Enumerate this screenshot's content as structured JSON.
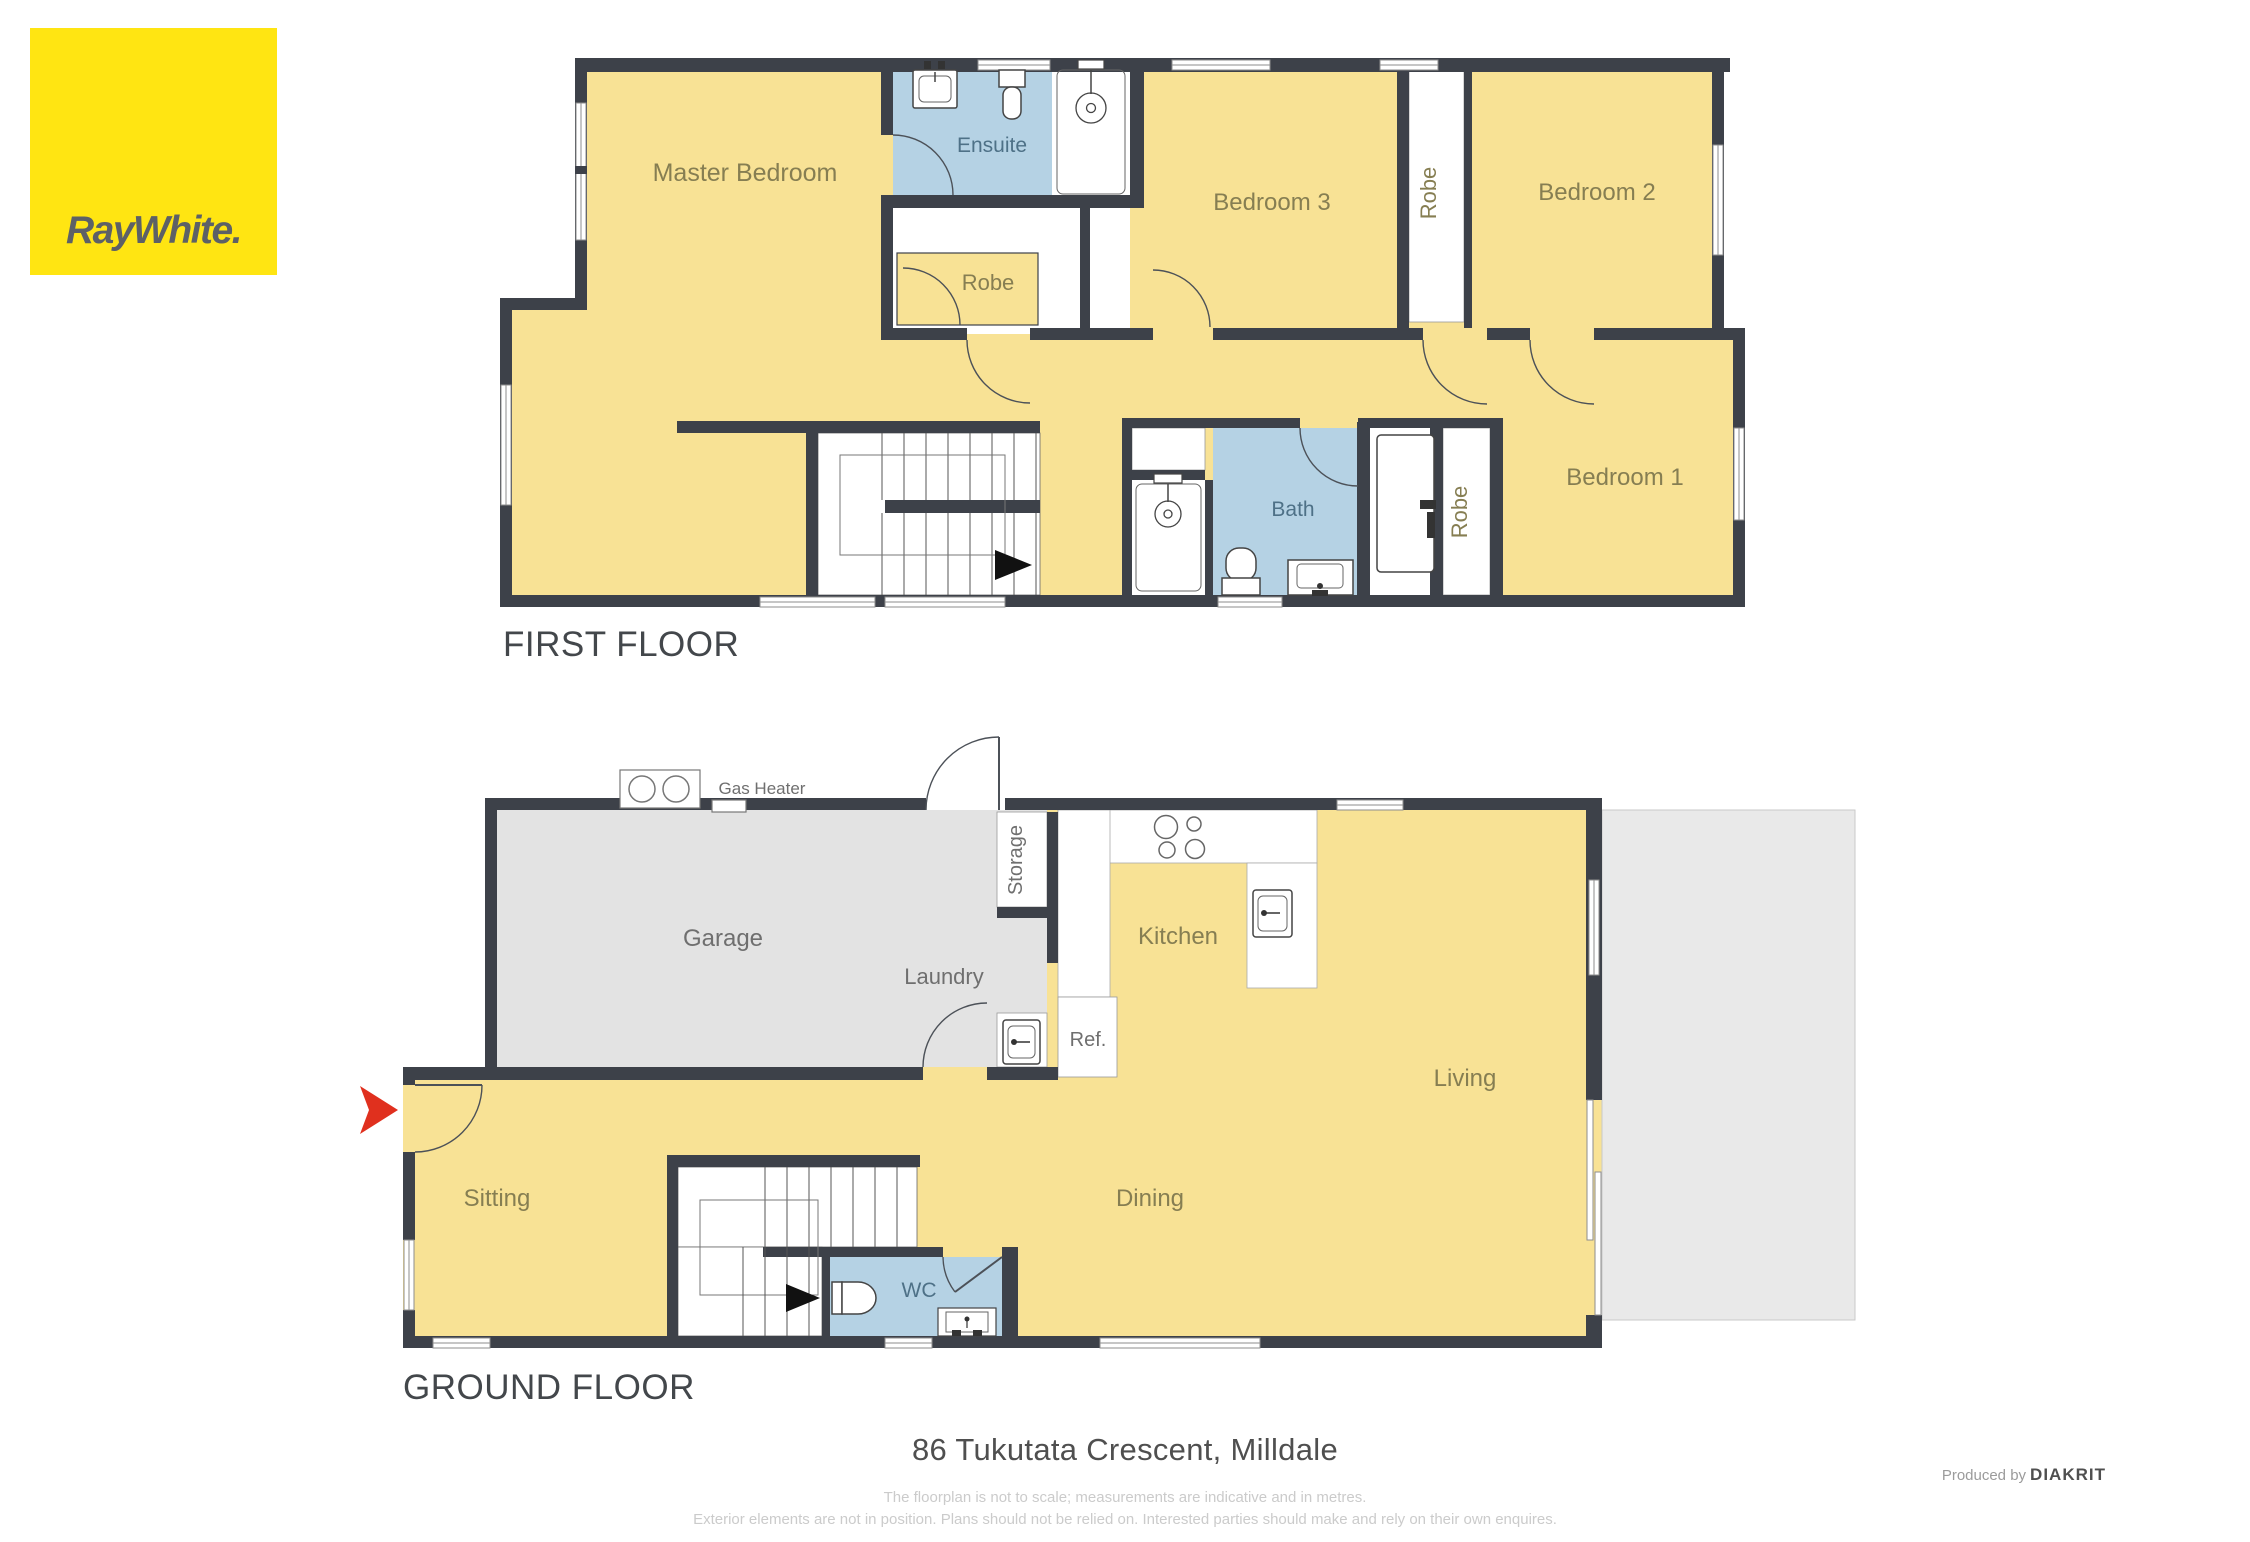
{
  "logo": {
    "text": "RayWhite.",
    "bg": "#ffe512",
    "fg": "#5d6166"
  },
  "first_floor": {
    "title": "FIRST FLOOR",
    "rooms": {
      "master_bedroom": "Master Bedroom",
      "ensuite": "Ensuite",
      "robe_master": "Robe",
      "bedroom3": "Bedroom 3",
      "robe_bedroom2": "Robe",
      "bedroom2": "Bedroom 2",
      "bedroom1": "Bedroom 1",
      "bath": "Bath",
      "robe_bedroom1": "Robe"
    }
  },
  "ground_floor": {
    "title": "GROUND FLOOR",
    "rooms": {
      "garage": "Garage",
      "gas_heater": "Gas Heater",
      "storage": "Storage",
      "laundry": "Laundry",
      "ref": "Ref.",
      "kitchen": "Kitchen",
      "living": "Living",
      "sitting": "Sitting",
      "dining": "Dining",
      "wc": "WC"
    }
  },
  "footer": {
    "address": "86 Tukutata Crescent, Milldale",
    "disclaimer_line1": "The floorplan is not to scale; measurements are indicative and in metres.",
    "disclaimer_line2": "Exterior elements are not in position. Plans should not be relied on. Interested parties should make and rely on their own enquires.",
    "produced_by": "Produced by",
    "producer": "DIAKRIT"
  },
  "colors": {
    "room_yellow": "#f8e295",
    "wet_area_blue": "#b5d2e4",
    "wall_dark": "#3d4149",
    "garage_gray": "#e3e3e3",
    "deck_gray": "#e9e9e9",
    "entry_arrow_red": "#e0301e",
    "logo_yellow": "#ffe512"
  }
}
